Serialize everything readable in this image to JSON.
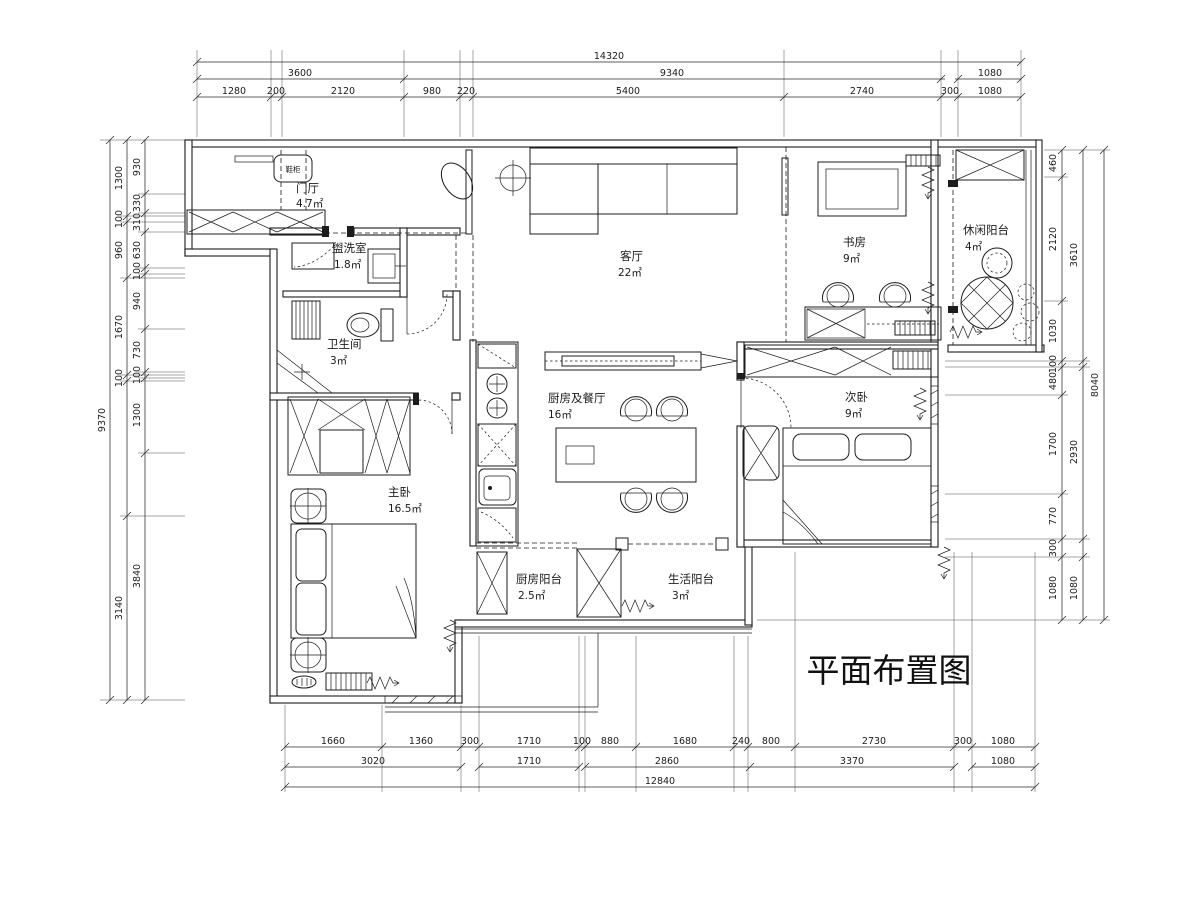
{
  "title": "平面布置图",
  "entry_tag": "鞋柜",
  "rooms": {
    "entry": {
      "name": "门厅",
      "area": "4.7㎡"
    },
    "washroom": {
      "name": "盥洗室",
      "area": "1.8㎡"
    },
    "living": {
      "name": "客厅",
      "area": "22㎡"
    },
    "study": {
      "name": "书房",
      "area": "9㎡"
    },
    "leisure_balcony": {
      "name": "休闲阳台",
      "area": "4㎡"
    },
    "bathroom": {
      "name": "卫生间",
      "area": "3㎡"
    },
    "kitchen_dining": {
      "name": "厨房及餐厅",
      "area": "16㎡"
    },
    "second_bedroom": {
      "name": "次卧",
      "area": "9㎡"
    },
    "master_bedroom": {
      "name": "主卧",
      "area": "16.5㎡"
    },
    "kitchen_balcony": {
      "name": "厨房阳台",
      "area": "2.5㎡"
    },
    "service_balcony": {
      "name": "生活阳台",
      "area": "3㎡"
    }
  },
  "dims": {
    "top": {
      "total": "14320",
      "row2": [
        "3600",
        "9340",
        "1080"
      ],
      "row3": [
        "1280",
        "200",
        "2120",
        "980",
        "220",
        "5400",
        "2740",
        "300",
        "1080"
      ]
    },
    "bottom": {
      "row1": [
        "1660",
        "1360",
        "300",
        "1710",
        "100",
        "880",
        "1680",
        "240",
        "800",
        "2730",
        "300",
        "1080"
      ],
      "row2": [
        "3020",
        "1710",
        "2860",
        "3370",
        "1080"
      ],
      "total": "12840"
    },
    "left": {
      "total": "9370",
      "mid": [
        "1300",
        "100",
        "960",
        "1670",
        "100",
        "3140"
      ],
      "inner": [
        "930",
        "330",
        "310",
        "630",
        "100",
        "940",
        "730",
        "100",
        "1300",
        "3840"
      ]
    },
    "right": {
      "total": "8040",
      "mid": [
        "3610",
        "2930",
        "1080"
      ],
      "inner": [
        "460",
        "2120",
        "1030",
        "100",
        "480",
        "1700",
        "770",
        "300",
        "1080"
      ]
    }
  }
}
